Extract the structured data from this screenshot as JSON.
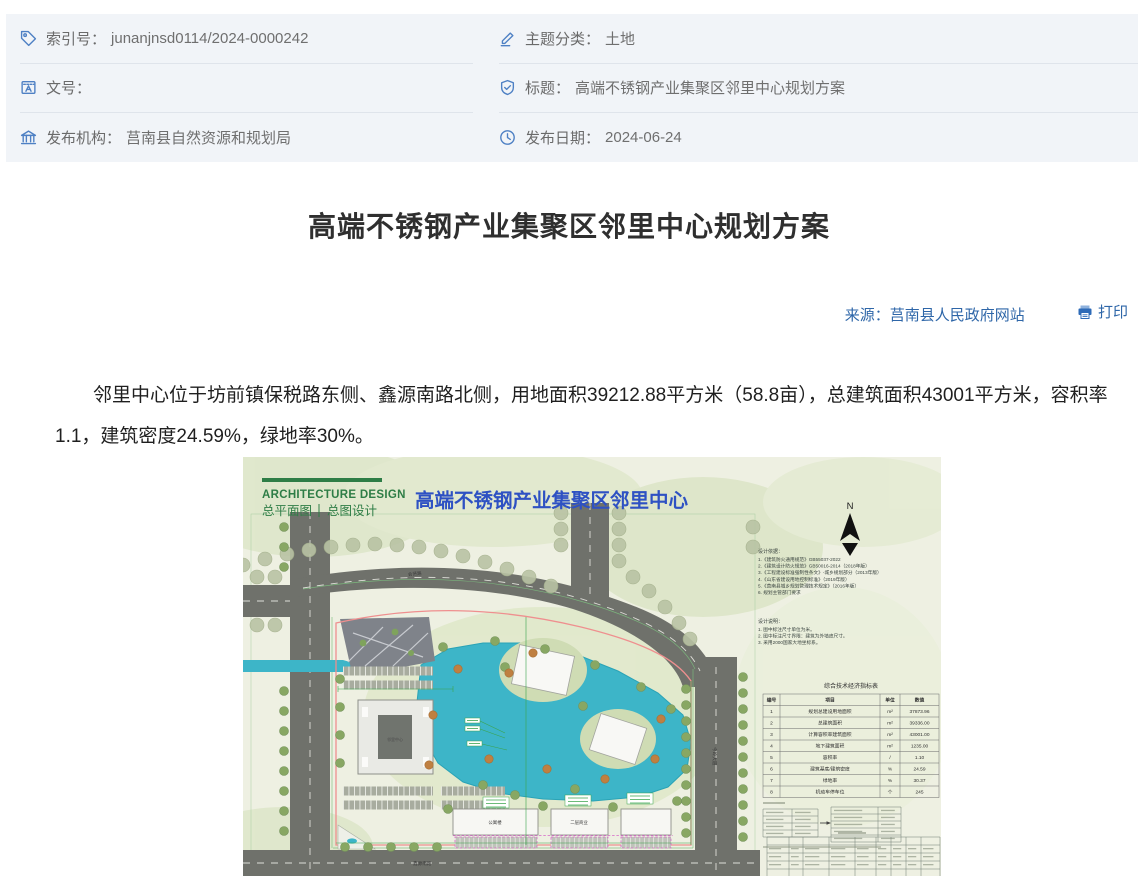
{
  "meta": {
    "items": [
      {
        "label": "索引号：",
        "value": "junanjnsd0114/2024-0000242"
      },
      {
        "label": "主题分类：",
        "value": "土地"
      },
      {
        "label": "文号：",
        "value": ""
      },
      {
        "label": "标题：",
        "value": "高端不锈钢产业集聚区邻里中心规划方案"
      },
      {
        "label": "发布机构：",
        "value": "莒南县自然资源和规划局"
      },
      {
        "label": "发布日期：",
        "value": "2024-06-24"
      }
    ]
  },
  "article": {
    "title": "高端不锈钢产业集聚区邻里中心规划方案",
    "source": "来源：莒南县人民政府网站",
    "print_label": "打印",
    "body": "邻里中心位于坊前镇保税路东侧、鑫源南路北侧，用地面积39212.88平方米（58.8亩），总建筑面积43001平方米，容积率1.1，建筑密度24.59%，绿地率30%。"
  },
  "plan": {
    "brand": "ARCHITECTURE DESIGN",
    "tab1": "总平面图",
    "tab2": "总图设计",
    "title": "高端不锈钢产业集聚区邻里中心",
    "north_label": "N",
    "basis_title": "设计依据：",
    "basis": [
      "1.《建筑防火通用规范》GB55037-2022",
      "2.《建筑设计防火规范》GB50016-2014（2018年版）",
      "3.《工程建设标准强制性条文》-城乡规划部分（2013年版）",
      "4.《山东省建设用地控制标准》（2019年版）",
      "5.《莒南县城乡规划管理技术规定》（2016年版）",
      "6. 规划主管部门要求"
    ],
    "notes_title": "设计说明：",
    "notes": [
      "1. 图中标注尺寸单位为米。",
      "2. 图中标注尺寸界限：建筑为外墙皮尺寸。",
      "3. 采用2000国家大地坐标系。"
    ],
    "roads": {
      "north": "会贤路",
      "east": "今岭大道",
      "south": "鑫源南路"
    },
    "buildings": {
      "main": "邻里中心",
      "b1": "公寓楼",
      "b2": "二层商业"
    },
    "table": {
      "title": "综合技术经济指标表",
      "headers": [
        "编号",
        "项目",
        "单位",
        "数值"
      ],
      "rows": [
        [
          "1",
          "规划总建设用地面积",
          "m²",
          "37873.96"
        ],
        [
          "2",
          "总建筑面积",
          "m²",
          "39336.00"
        ],
        [
          "3",
          "计算容积率建筑面积",
          "m²",
          "43001.00"
        ],
        [
          "4",
          "地下建筑面积",
          "m²",
          "1235.00"
        ],
        [
          "5",
          "容积率",
          "/",
          "1.10"
        ],
        [
          "6",
          "建筑基底/建筑密度",
          "%",
          "24.59"
        ],
        [
          "7",
          "绿地率",
          "%",
          "30.37"
        ],
        [
          "8",
          "机动车停车位",
          "个",
          "245"
        ]
      ]
    }
  }
}
